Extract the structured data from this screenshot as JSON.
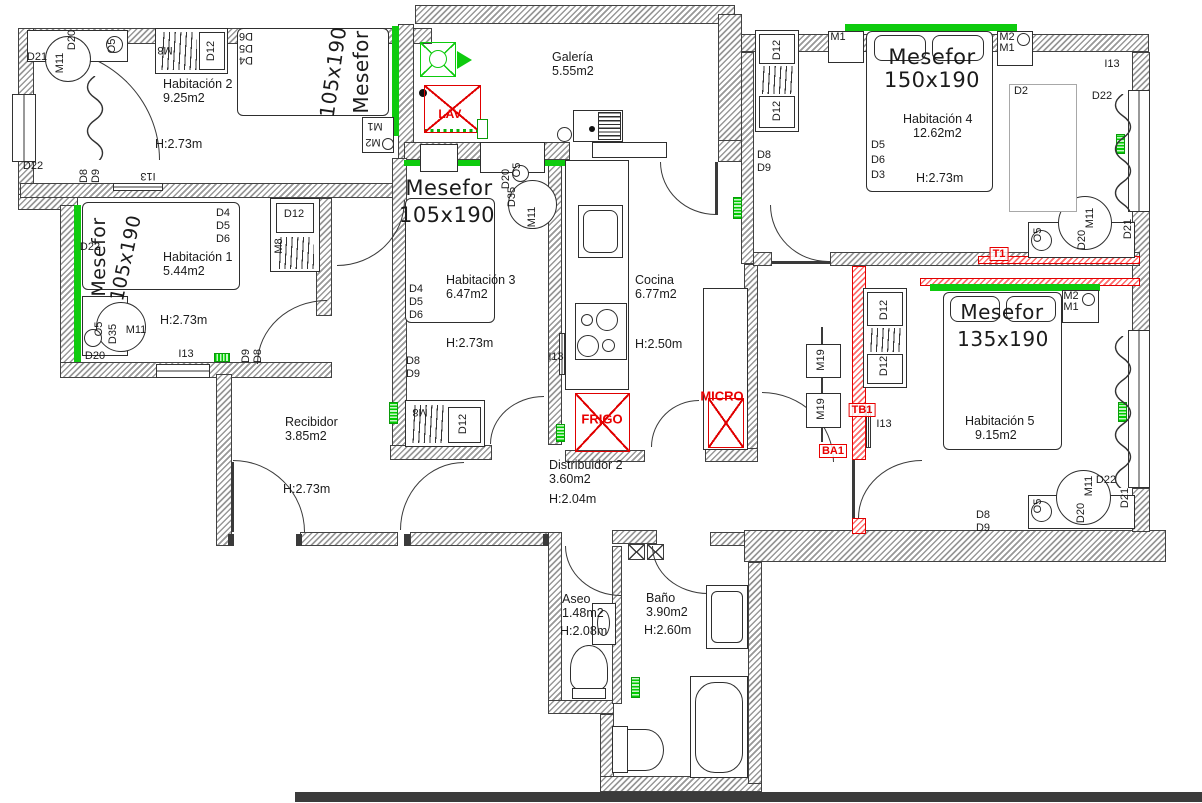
{
  "rooms": [
    {
      "key": "hab2",
      "name": "Habitación 2",
      "area": "9.25m2",
      "height": "H:2.73m",
      "nx": 163,
      "ny": 77,
      "hx": 155,
      "hy": 137
    },
    {
      "key": "galeria",
      "name": "Galería",
      "area": "5.55m2",
      "height": null,
      "nx": 552,
      "ny": 50
    },
    {
      "key": "hab4",
      "name": "Habitación 4",
      "area": "12.62m2",
      "height": "H:2.73m",
      "nx": 903,
      "ny": 112,
      "ax": 913,
      "hx": 916,
      "hy": 171
    },
    {
      "key": "hab1",
      "name": "Habitación 1",
      "area": "5.44m2",
      "height": "H:2.73m",
      "nx": 163,
      "ny": 250,
      "hx": 160,
      "hy": 313
    },
    {
      "key": "hab3",
      "name": "Habitación 3",
      "area": "6.47m2",
      "height": "H:2.73m",
      "nx": 446,
      "ny": 273,
      "hx": 446,
      "hy": 336
    },
    {
      "key": "cocina",
      "name": "Cocina",
      "area": "6.77m2",
      "height": "H:2.50m",
      "nx": 635,
      "ny": 273,
      "hx": 635,
      "hy": 337
    },
    {
      "key": "recibidor",
      "name": "Recibidor",
      "area": "3.85m2",
      "height": "H:2.73m",
      "nx": 285,
      "ny": 415,
      "hx": 283,
      "hy": 482
    },
    {
      "key": "distribuidor2",
      "name": "Distribuidor 2",
      "area": "3.60m2",
      "height": "H:2.04m",
      "nx": 549,
      "ny": 458,
      "hx": 549,
      "hy": 492
    },
    {
      "key": "hab5",
      "name": "Habitación 5",
      "area": "9.15m2",
      "height": null,
      "nx": 965,
      "ny": 414,
      "ax": 975
    },
    {
      "key": "aseo",
      "name": "Aseo",
      "area": "1.48m2",
      "height": "H:2.08m",
      "nx": 562,
      "ny": 592,
      "hx": 560,
      "hy": 624
    },
    {
      "key": "bano",
      "name": "Baño",
      "area": "3.90m2",
      "height": "H:2.60m",
      "nx": 646,
      "ny": 591,
      "hx": 644,
      "hy": 623
    }
  ],
  "annotations": [
    {
      "t": "D21",
      "x": 37,
      "y": 57
    },
    {
      "t": "D20",
      "x": 72,
      "y": 40,
      "r": -90
    },
    {
      "t": "M11",
      "x": 60,
      "y": 63,
      "r": -90
    },
    {
      "t": "O5",
      "x": 112,
      "y": 46,
      "r": -90
    },
    {
      "t": "M8",
      "x": 165,
      "y": 50,
      "r": 180
    },
    {
      "t": "D12",
      "x": 211,
      "y": 51,
      "r": -90
    },
    {
      "t": "D6",
      "x": 246,
      "y": 36,
      "r": 180
    },
    {
      "t": "D5",
      "x": 246,
      "y": 48,
      "r": 180
    },
    {
      "t": "D4",
      "x": 246,
      "y": 60,
      "r": 180
    },
    {
      "t": "Mesefor",
      "x": 361,
      "y": 72,
      "r": -90,
      "s": 20,
      "n": "bed-label-hab2"
    },
    {
      "t": "105x190",
      "x": 333,
      "y": 72,
      "r": -82,
      "s": 20,
      "n": "bed-size-hab2"
    },
    {
      "t": "M1",
      "x": 375,
      "y": 126,
      "r": 180
    },
    {
      "t": "M2",
      "x": 373,
      "y": 142,
      "r": 180
    },
    {
      "t": "D22",
      "x": 33,
      "y": 166
    },
    {
      "t": "D8",
      "x": 84,
      "y": 176,
      "r": -90
    },
    {
      "t": "D9",
      "x": 96,
      "y": 176,
      "r": -90
    },
    {
      "t": "I13",
      "x": 148,
      "y": 176,
      "r": 180
    },
    {
      "t": "LAV.",
      "x": 451,
      "y": 114,
      "c": "red",
      "s": 12
    },
    {
      "t": "M1",
      "x": 838,
      "y": 37
    },
    {
      "t": "Mesefor",
      "x": 932,
      "y": 57,
      "s": 21,
      "n": "bed-label-hab4"
    },
    {
      "t": "150x190",
      "x": 932,
      "y": 80,
      "s": 21,
      "n": "bed-size-hab4"
    },
    {
      "t": "M2",
      "x": 1007,
      "y": 37
    },
    {
      "t": "M1",
      "x": 1007,
      "y": 48
    },
    {
      "t": "D2",
      "x": 1021,
      "y": 91
    },
    {
      "t": "I13",
      "x": 1112,
      "y": 64
    },
    {
      "t": "D22",
      "x": 1102,
      "y": 96
    },
    {
      "t": "D5",
      "x": 878,
      "y": 145
    },
    {
      "t": "D6",
      "x": 878,
      "y": 160
    },
    {
      "t": "D3",
      "x": 878,
      "y": 175
    },
    {
      "t": "O5",
      "x": 1038,
      "y": 235,
      "r": -90
    },
    {
      "t": "D20",
      "x": 1082,
      "y": 240,
      "r": -90
    },
    {
      "t": "M11",
      "x": 1090,
      "y": 218,
      "r": -90
    },
    {
      "t": "D21",
      "x": 1128,
      "y": 229,
      "r": -90
    },
    {
      "t": "D8",
      "x": 764,
      "y": 155
    },
    {
      "t": "D9",
      "x": 764,
      "y": 168
    },
    {
      "t": "D12",
      "x": 777,
      "y": 50,
      "r": -90
    },
    {
      "t": "D12",
      "x": 777,
      "y": 111,
      "r": -90
    },
    {
      "t": "T1",
      "x": 999,
      "y": 254,
      "c": "red",
      "box": 1
    },
    {
      "t": "D22",
      "x": 90,
      "y": 247
    },
    {
      "t": "Mesefor",
      "x": 99,
      "y": 257,
      "r": -90,
      "s": 19,
      "n": "bed-label-hab1"
    },
    {
      "t": "105x190",
      "x": 126,
      "y": 258,
      "r": -78,
      "s": 19,
      "n": "bed-size-hab1"
    },
    {
      "t": "D4",
      "x": 223,
      "y": 213
    },
    {
      "t": "D5",
      "x": 223,
      "y": 226
    },
    {
      "t": "D6",
      "x": 223,
      "y": 239
    },
    {
      "t": "D12",
      "x": 294,
      "y": 214
    },
    {
      "t": "M8",
      "x": 279,
      "y": 246,
      "r": -90
    },
    {
      "t": "M11",
      "x": 136,
      "y": 330
    },
    {
      "t": "O5",
      "x": 99,
      "y": 329,
      "r": -90
    },
    {
      "t": "D35",
      "x": 113,
      "y": 334,
      "r": -90
    },
    {
      "t": "D20",
      "x": 95,
      "y": 356
    },
    {
      "t": "I13",
      "x": 186,
      "y": 354
    },
    {
      "t": "D9",
      "x": 246,
      "y": 356,
      "r": -90
    },
    {
      "t": "D8",
      "x": 258,
      "y": 356,
      "r": -90
    },
    {
      "t": "Mesefor",
      "x": 449,
      "y": 188,
      "s": 21,
      "n": "bed-label-hab3"
    },
    {
      "t": "105x190",
      "x": 447,
      "y": 215,
      "s": 21,
      "n": "bed-size-hab3"
    },
    {
      "t": "D20",
      "x": 506,
      "y": 179,
      "r": -90
    },
    {
      "t": "O5",
      "x": 517,
      "y": 170,
      "r": -90
    },
    {
      "t": "D35",
      "x": 512,
      "y": 197,
      "r": -90
    },
    {
      "t": "M11",
      "x": 532,
      "y": 217,
      "r": -90
    },
    {
      "t": "D4",
      "x": 416,
      "y": 289
    },
    {
      "t": "D5",
      "x": 416,
      "y": 302
    },
    {
      "t": "D6",
      "x": 416,
      "y": 315
    },
    {
      "t": "D8",
      "x": 413,
      "y": 361
    },
    {
      "t": "D9",
      "x": 413,
      "y": 374
    },
    {
      "t": "I13",
      "x": 556,
      "y": 357
    },
    {
      "t": "M8",
      "x": 420,
      "y": 412,
      "r": 180
    },
    {
      "t": "D12",
      "x": 463,
      "y": 424,
      "r": -90
    },
    {
      "t": "FRIGO",
      "x": 602,
      "y": 419,
      "c": "red",
      "s": 13
    },
    {
      "t": "MICRO",
      "x": 722,
      "y": 396,
      "c": "red",
      "s": 13
    },
    {
      "t": "M19",
      "x": 821,
      "y": 360,
      "r": -90
    },
    {
      "t": "M19",
      "x": 821,
      "y": 409,
      "r": -90
    },
    {
      "t": "TB1",
      "x": 862,
      "y": 410,
      "c": "red",
      "box": 1
    },
    {
      "t": "BA1",
      "x": 833,
      "y": 451,
      "c": "red",
      "box": 1
    },
    {
      "t": "I13",
      "x": 884,
      "y": 424
    },
    {
      "t": "D12",
      "x": 884,
      "y": 310,
      "r": -90
    },
    {
      "t": "D12",
      "x": 884,
      "y": 366,
      "r": -90
    },
    {
      "t": "Mesefor",
      "x": 1002,
      "y": 312,
      "s": 20,
      "n": "bed-label-hab5"
    },
    {
      "t": "135x190",
      "x": 1003,
      "y": 339,
      "s": 20,
      "n": "bed-size-hab5"
    },
    {
      "t": "M2",
      "x": 1071,
      "y": 296
    },
    {
      "t": "M1",
      "x": 1071,
      "y": 307
    },
    {
      "t": "O5",
      "x": 1038,
      "y": 506,
      "r": -90
    },
    {
      "t": "D20",
      "x": 1081,
      "y": 513,
      "r": -90
    },
    {
      "t": "M11",
      "x": 1089,
      "y": 486,
      "r": -90
    },
    {
      "t": "D21",
      "x": 1125,
      "y": 498,
      "r": -90
    },
    {
      "t": "D22",
      "x": 1106,
      "y": 480
    },
    {
      "t": "D8",
      "x": 983,
      "y": 515
    },
    {
      "t": "D9",
      "x": 983,
      "y": 528
    }
  ]
}
